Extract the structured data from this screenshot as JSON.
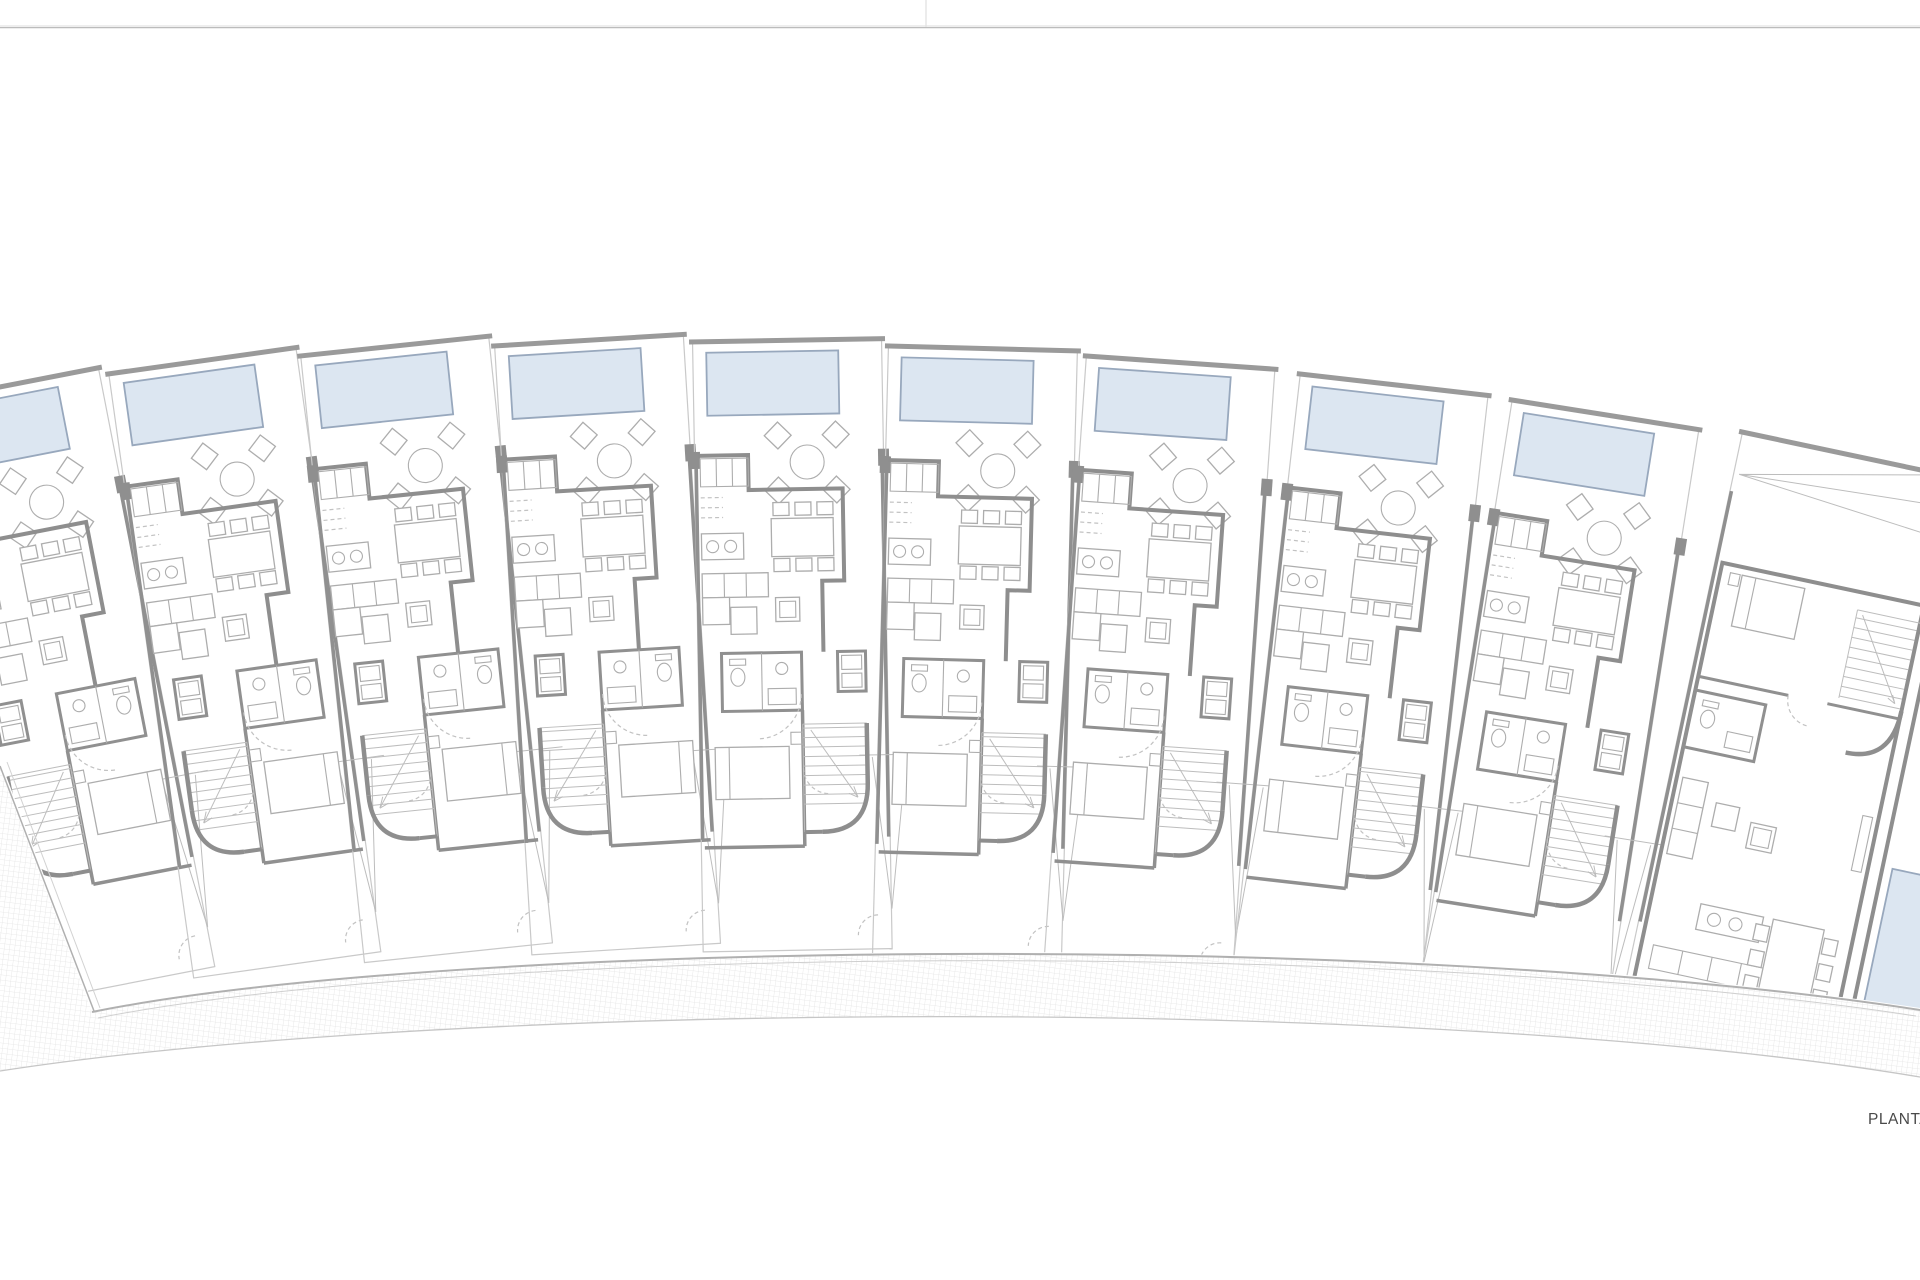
{
  "page": {
    "width": 1920,
    "height": 1280,
    "background": "#ffffff",
    "top_rule": {
      "y": 27,
      "color": "#bcbcbc",
      "tick_x": 926,
      "tick_color": "#e2e2e2"
    }
  },
  "plan": {
    "label": "PLANTA",
    "label_color": "#4a4a4a",
    "label_font_size": 15.5,
    "label_x": 1868,
    "label_y": 1124,
    "standard_unit_count": 9,
    "colors": {
      "wall": "#8e8e8e",
      "wall_light": "#9a9a9a",
      "lot_line": "#c9c9c9",
      "furniture_line": "#adadad",
      "pool_fill": "#dce6f1",
      "pool_stroke": "#98a8bd",
      "pavement_hatch": "#e4e4e4",
      "road_edge": "#b0b0b0",
      "door_swing_dash": "#c2c2c2"
    },
    "units": [
      {
        "id": "1",
        "x": -88,
        "y": 402,
        "rotation": -11,
        "stairs": "L"
      },
      {
        "id": "2",
        "x": 108,
        "y": 372,
        "rotation": -8,
        "stairs": "L"
      },
      {
        "id": "3",
        "x": 300,
        "y": 354,
        "rotation": -6,
        "stairs": "L"
      },
      {
        "id": "4",
        "x": 494,
        "y": 344,
        "rotation": -3.5,
        "stairs": "L"
      },
      {
        "id": "5",
        "x": 692,
        "y": 340,
        "rotation": -1,
        "stairs": "R"
      },
      {
        "id": "6",
        "x": 888,
        "y": 344,
        "rotation": 1.5,
        "stairs": "R"
      },
      {
        "id": "7",
        "x": 1086,
        "y": 354,
        "rotation": 4,
        "stairs": "R"
      },
      {
        "id": "8",
        "x": 1300,
        "y": 372,
        "rotation": 6.5,
        "stairs": "R"
      },
      {
        "id": "9",
        "x": 1512,
        "y": 398,
        "rotation": 9,
        "stairs": "R"
      }
    ],
    "end_unit": {
      "id": "10",
      "x": 1742,
      "y": 432,
      "rotation": 12
    },
    "unit_features": [
      "pool",
      "patio-round-table",
      "patio-chairs",
      "kitchen-cabinets",
      "kitchen-island",
      "dining-table",
      "dining-chairs",
      "sofa",
      "chaise",
      "armchair",
      "coffee-table",
      "bathroom-toilet",
      "bathroom-sink",
      "bedroom-bed",
      "staircase",
      "door-swings",
      "rear-garden-wedge",
      "rear-fence-line"
    ],
    "road": {
      "type": "curved-pavement-band",
      "texture": "fine-grid-hatch"
    }
  }
}
